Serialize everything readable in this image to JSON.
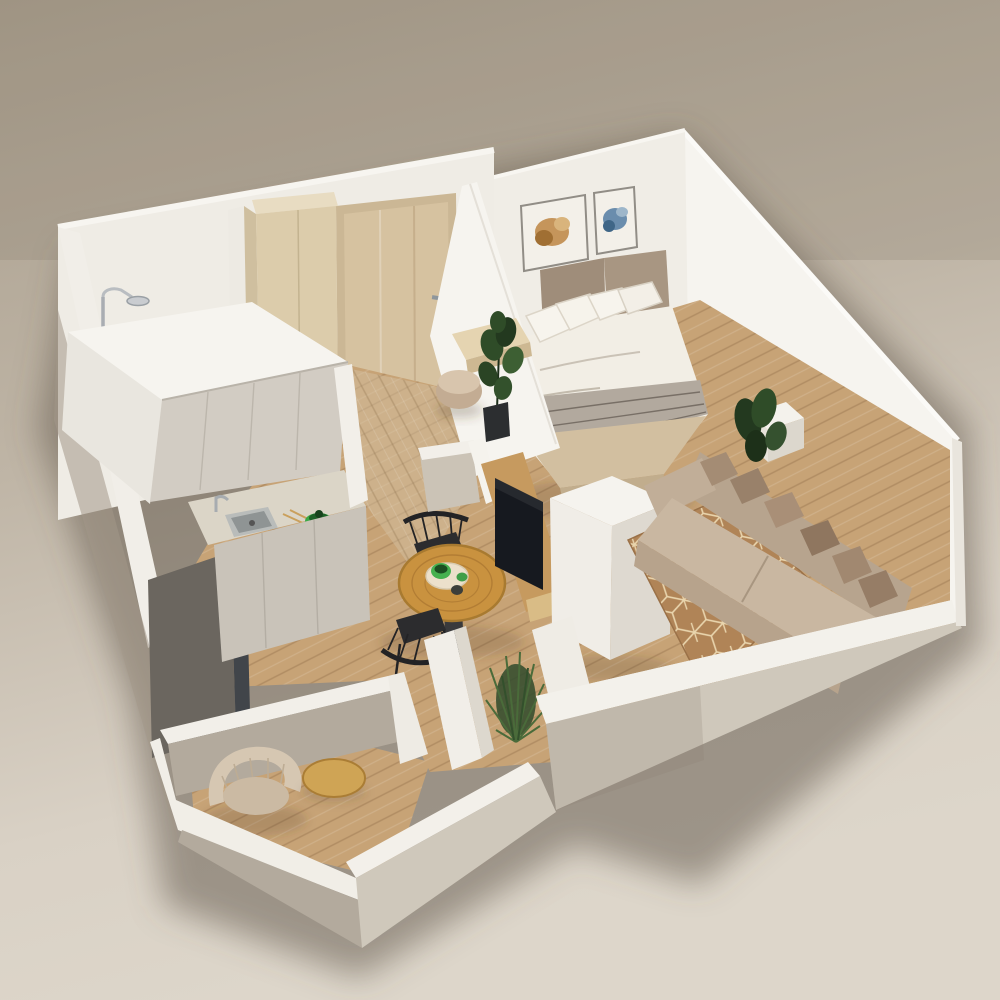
{
  "scene": {
    "title": "3D isometric cutaway floor plan render of a studio apartment",
    "style": "photorealistic architectural visualization, bird's-eye dimetric view",
    "rooms": {
      "bedroom": "Bedroom with double bed, two framed artworks, potted plants",
      "living": "Living area with beige sofa, throw pillows, geometric rug",
      "kitchen": "Kitchen with white cabinets, sink, green pot, tall dark unit",
      "hallway": "Hallway with wood entry door, wardrobe, console, pouf, fiddle-leaf plant",
      "shower": "Shower corner with chrome rain shower fixture",
      "dining": "Dining nook with round wood table, two black spindle chairs, green cups",
      "lounge": "Small lounge room with curved beige armchair and oval wood side table",
      "tv_nook": "Media wall with wood panel and flat TV"
    },
    "objects": [
      "double-bed",
      "white-pillows",
      "striped-throw",
      "beige-blanket",
      "headboard",
      "artwork-amber-floral",
      "artwork-blue-floral",
      "sofa",
      "taupe-pillows",
      "cube-pattern-rug",
      "round-dining-table",
      "black-spindle-chair",
      "green-cups",
      "serving-plate",
      "kitchen-sink",
      "chrome-faucet",
      "green-pot",
      "upper-cabinets",
      "base-cabinets",
      "tall-dark-unit",
      "entry-door",
      "wardrobe",
      "wall-console",
      "pouf",
      "fiddle-leaf-plant",
      "rain-shower",
      "tv",
      "tv-wood-panel",
      "white-column",
      "spiky-plant",
      "curved-armchair",
      "oval-side-table",
      "potted-plant-bedroom",
      "potted-plant-sofa",
      "bedside-white-box"
    ],
    "floor_material": "light oak planks",
    "wall_material": "white painted walls, cutaway tops"
  },
  "palette": {
    "bg_top": "#a89d8c",
    "bg_mid": "#c2b8a9",
    "bg_bottom": "#ddd6ca",
    "wall_bright": "#f6f4ef",
    "wall_white": "#efece5",
    "wall_cut": "#f3f1eb",
    "wall_shadow": "#b3aa9d",
    "wall_outer_light": "#cfc8bb",
    "floor_wood": "#c7a376",
    "floor_line": "#8d6b49",
    "hall_wood": "#d4c0a0",
    "door_wood": "#d6c2a0",
    "cabinet_light": "#d2ccc3",
    "cabinet_base": "#c9c3b9",
    "cabinet_dark": "#6b665f",
    "counter": "#dbd5c7",
    "accent_green": "#3aa845",
    "accent_green_dark": "#1e6128",
    "table_wood": "#c9923f",
    "chair_black": "#2c2c2e",
    "sofa_beige": "#c9b7a1",
    "sofa_back": "#b7a48e",
    "pillow_taupe": "#a48c74",
    "rug_brown": "#b08457",
    "rug_line": "#ecd9b2",
    "bed_white": "#f2eee5",
    "bed_blanket": "#d2bfa0",
    "headboard": "#9f8d7a",
    "throw_gray": "#b2a99e",
    "tv_black": "#16191f",
    "tv_wall_wood": "#c69a5f",
    "plant_green": "#2f4c28",
    "plant_green_dark": "#23391f",
    "art_amber": "#c08b4b",
    "art_blue": "#5b82a6",
    "chrome": "#b9bdc1"
  }
}
